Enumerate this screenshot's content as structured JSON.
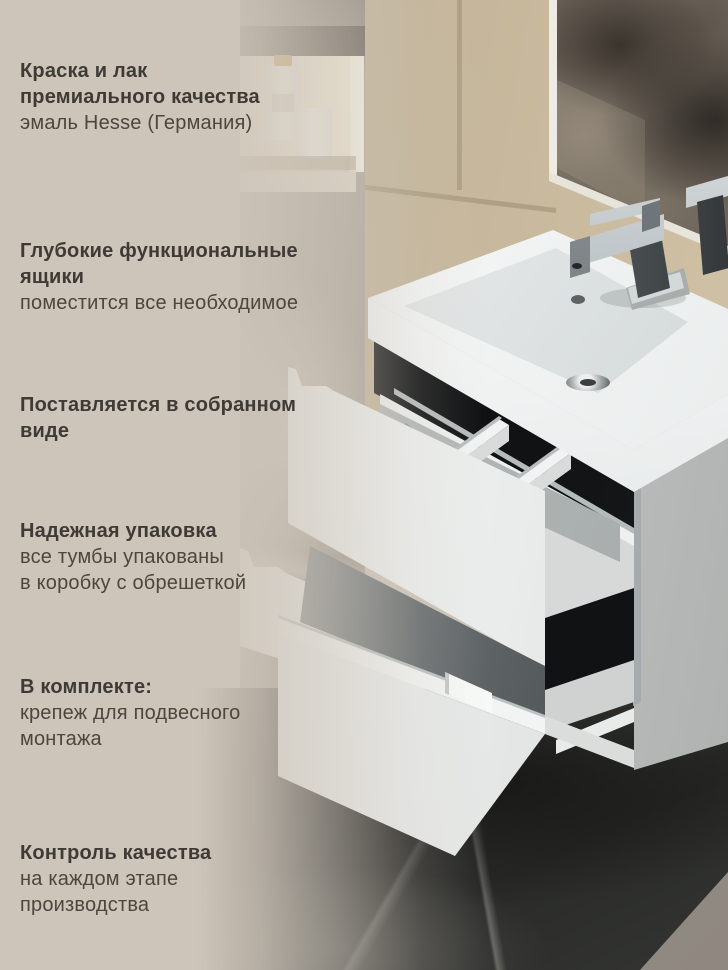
{
  "page": {
    "kind": "product-infographic",
    "language": "ru"
  },
  "features": [
    {
      "title_lines": [
        "Краска и лак",
        "премиального качества"
      ],
      "desc_lines": [
        "эмаль Hesse (Германия)"
      ]
    },
    {
      "title_lines": [
        "Глубокие функциональные",
        "ящики"
      ],
      "desc_lines": [
        "поместится все необходимое"
      ]
    },
    {
      "title_lines": [
        "Поставляется в собранном",
        "виде"
      ],
      "desc_lines": []
    },
    {
      "title_lines": [
        "Надежная упаковка"
      ],
      "desc_lines": [
        "все тумбы упакованы",
        "в коробку с обрешеткой"
      ]
    },
    {
      "title_lines": [
        "В комплекте:"
      ],
      "desc_lines": [
        "крепеж для подвесного",
        "монтажа"
      ]
    },
    {
      "title_lines": [
        "Контроль качества"
      ],
      "desc_lines": [
        "на каждом этапе",
        "производства"
      ]
    }
  ],
  "colors": {
    "panel_beige": "#CDC5B9",
    "title_text": "#3E3A36",
    "body_text": "#4C463F",
    "tile_beige": "#C6B89D",
    "marble_dark": "#343534",
    "cabinet_white": "#F4F5F4",
    "recess_black": "#17191B",
    "chrome": "#9EA4A7",
    "bottle_cap_gold": "#C8A868"
  }
}
